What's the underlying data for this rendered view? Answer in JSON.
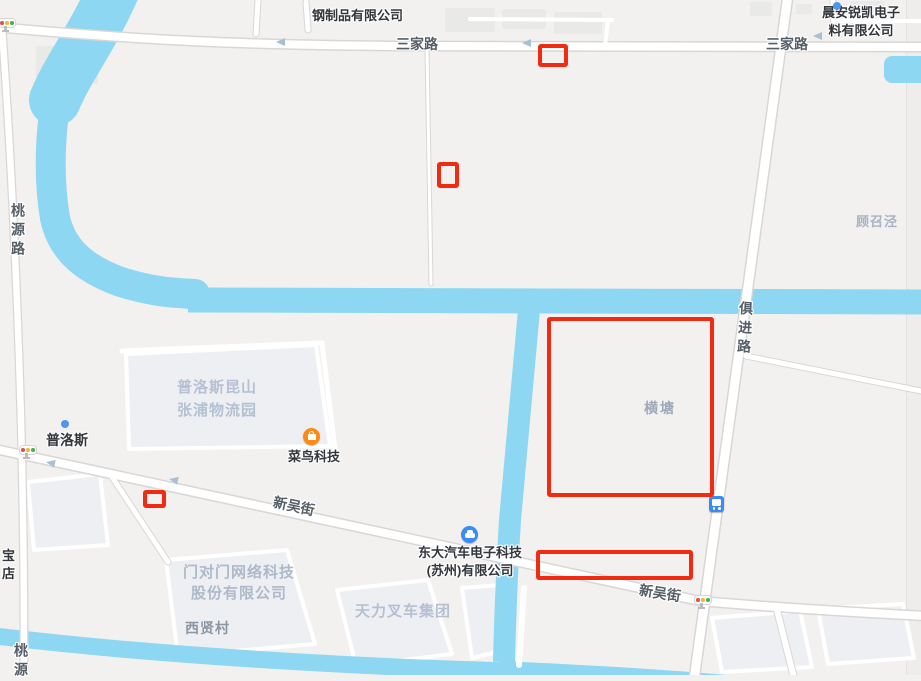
{
  "colors": {
    "land": "#f2f1ef",
    "water": "#8dd7f2",
    "road_fill": "#ffffff",
    "road_casing": "#d9d7d5",
    "building": "#edeff3",
    "annotation_red": "#f12a12",
    "poi_orange": "#ff8a14",
    "poi_blue": "#3a8bf5"
  },
  "roads": {
    "sanjialu": "三家路",
    "taoyuanlu": "桃源路",
    "jujinlu": "俱进路",
    "xinwujie": "新吴街",
    "taoyuan_partial": "桃源"
  },
  "pois": {
    "steel_company": "钢制品有限公司",
    "chenan_line1": "晨安锐凯电子",
    "chenan_line2": "料有限公司",
    "prologis": "普洛斯",
    "cainiao": "菜鸟科技",
    "dongda_line1": "东大汽车电子科技",
    "dongda_line2": "(苏州)有限公司",
    "bao_line1": "宝",
    "bao_line2": "店"
  },
  "areas": {
    "prologis_park_line1": "普洛斯昆山",
    "prologis_park_line2": "张浦物流园",
    "menduimen_line1": "门对门网络科技",
    "menduimen_line2": "股份有限公司",
    "tianli": "天力叉车集团",
    "xixiancun": "西贤村",
    "hengtang": "横塘",
    "guzhaojing": "顾召泾"
  },
  "icons": {
    "bus_stop": "bus-stop",
    "traffic_light": "traffic-light",
    "cainiao_icon": "shopping-bag",
    "car_icon": "car",
    "marker_dot": "blue-dot"
  },
  "annotations": {
    "color": "#f12a12",
    "boxes": [
      {
        "style": "left:538px;top:44px;width:30px;height:23px"
      },
      {
        "style": "left:437px;top:162px;width:22px;height:26px"
      },
      {
        "style": "left:547px;top:317px;width:167px;height:180px"
      },
      {
        "style": "left:143px;top:490px;width:23px;height:18px"
      },
      {
        "style": "left:536px;top:550px;width:157px;height:30px"
      }
    ]
  }
}
